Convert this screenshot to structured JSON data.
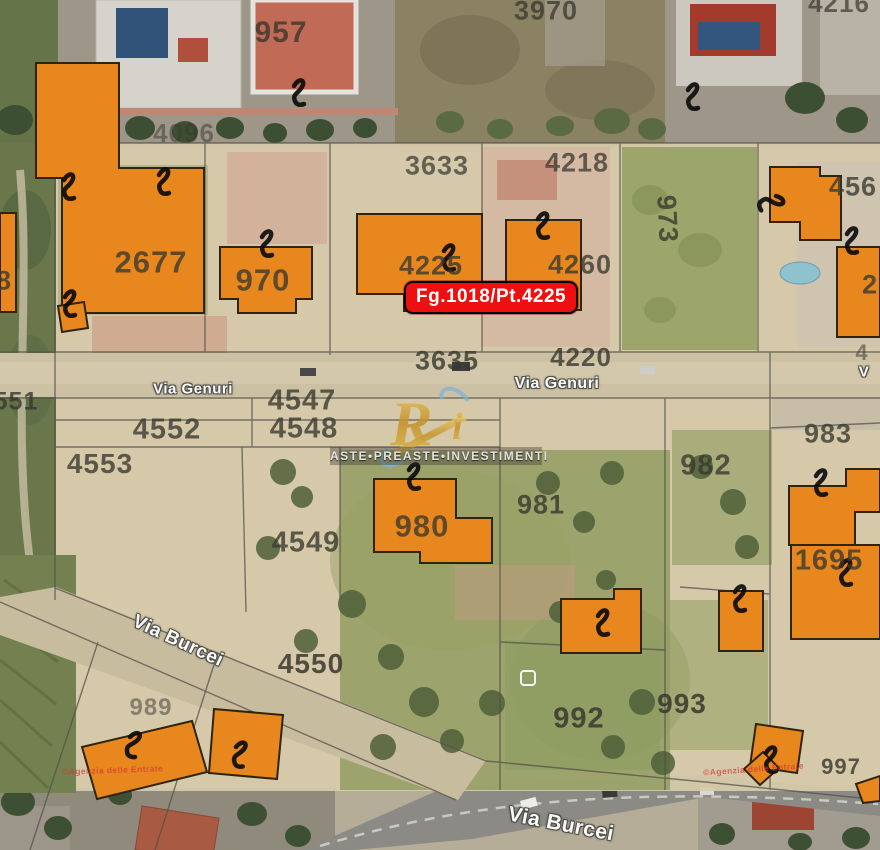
{
  "colors": {
    "parcel-orange": "#e8871e",
    "parcel-outline": "#2f2410",
    "highlight-red": "#ee1010",
    "number-gray": "#38382e",
    "street-white": "#ffffff",
    "gold": "#d2a033",
    "swoosh-blue": "#7fb2d9"
  },
  "highlight": {
    "label": "Fg.1018/Pt.4225"
  },
  "watermark": {
    "logo": "R",
    "logo_accent": "i",
    "tagline": "ASTE•PREASTE•INVESTIMENTI"
  },
  "copyright": {
    "left": "©Agenzia delle Entrate",
    "right": "©Agenzia delle Entrate"
  },
  "labels": [
    {
      "text": "957",
      "x": 281,
      "y": 33,
      "size": 30
    },
    {
      "text": "3970",
      "x": 546,
      "y": 11,
      "size": 27,
      "op": 0.75
    },
    {
      "text": "4216",
      "x": 839,
      "y": 3,
      "size": 26,
      "op": 0.7
    },
    {
      "text": "4096",
      "x": 184,
      "y": 133,
      "size": 26,
      "op": 0.5
    },
    {
      "text": "3633",
      "x": 437,
      "y": 166,
      "size": 27,
      "op": 0.72
    },
    {
      "text": "4218",
      "x": 577,
      "y": 163,
      "size": 27,
      "op": 0.75
    },
    {
      "text": "973",
      "x": 667,
      "y": 219,
      "size": 27,
      "rot": 87
    },
    {
      "text": "456",
      "x": 853,
      "y": 187,
      "size": 27
    },
    {
      "text": "2677",
      "x": 151,
      "y": 262,
      "size": 31
    },
    {
      "text": "970",
      "x": 263,
      "y": 280,
      "size": 31
    },
    {
      "text": "4225",
      "x": 431,
      "y": 266,
      "size": 27
    },
    {
      "text": "4260",
      "x": 580,
      "y": 265,
      "size": 27
    },
    {
      "text": "3635",
      "x": 447,
      "y": 361,
      "size": 27,
      "op": 0.8
    },
    {
      "text": "4220",
      "x": 581,
      "y": 357,
      "size": 26,
      "op": 0.8
    },
    {
      "text": "4",
      "x": 862,
      "y": 353,
      "size": 22,
      "op": 0.55
    },
    {
      "text": "551",
      "x": 16,
      "y": 402,
      "size": 25,
      "op": 0.8
    },
    {
      "text": "4552",
      "x": 167,
      "y": 430,
      "size": 29
    },
    {
      "text": "4547",
      "x": 302,
      "y": 401,
      "size": 29
    },
    {
      "text": "4548",
      "x": 304,
      "y": 429,
      "size": 29
    },
    {
      "text": "4553",
      "x": 100,
      "y": 464,
      "size": 28
    },
    {
      "text": "983",
      "x": 828,
      "y": 434,
      "size": 27
    },
    {
      "text": "982",
      "x": 706,
      "y": 466,
      "size": 29
    },
    {
      "text": "981",
      "x": 541,
      "y": 505,
      "size": 27,
      "op": 0.8
    },
    {
      "text": "980",
      "x": 422,
      "y": 526,
      "size": 31
    },
    {
      "text": "4549",
      "x": 306,
      "y": 543,
      "size": 29
    },
    {
      "text": "1695",
      "x": 829,
      "y": 561,
      "size": 29
    },
    {
      "text": "4550",
      "x": 311,
      "y": 664,
      "size": 28,
      "op": 0.85
    },
    {
      "text": "992",
      "x": 579,
      "y": 719,
      "size": 29,
      "op": 0.85
    },
    {
      "text": "993",
      "x": 682,
      "y": 704,
      "size": 28,
      "op": 0.85
    },
    {
      "text": "989",
      "x": 151,
      "y": 708,
      "size": 24,
      "op": 0.5
    },
    {
      "text": "997",
      "x": 841,
      "y": 767,
      "size": 22,
      "op": 0.8
    },
    {
      "text": "8",
      "x": 4,
      "y": 281,
      "size": 27
    },
    {
      "text": "27",
      "x": 878,
      "y": 285,
      "size": 27
    },
    {
      "text": "Via Genuri",
      "x": 193,
      "y": 389,
      "size": 15,
      "cls": "street"
    },
    {
      "text": "Via Genuri",
      "x": 557,
      "y": 384,
      "size": 16,
      "cls": "street"
    },
    {
      "text": "Via Burcei",
      "x": 178,
      "y": 641,
      "size": 19,
      "rot": 25,
      "cls": "street"
    },
    {
      "text": "Via Burcei",
      "x": 561,
      "y": 824,
      "size": 21,
      "rot": 11,
      "cls": "street"
    },
    {
      "text": "V",
      "x": 864,
      "y": 372,
      "size": 15,
      "cls": "street"
    }
  ]
}
